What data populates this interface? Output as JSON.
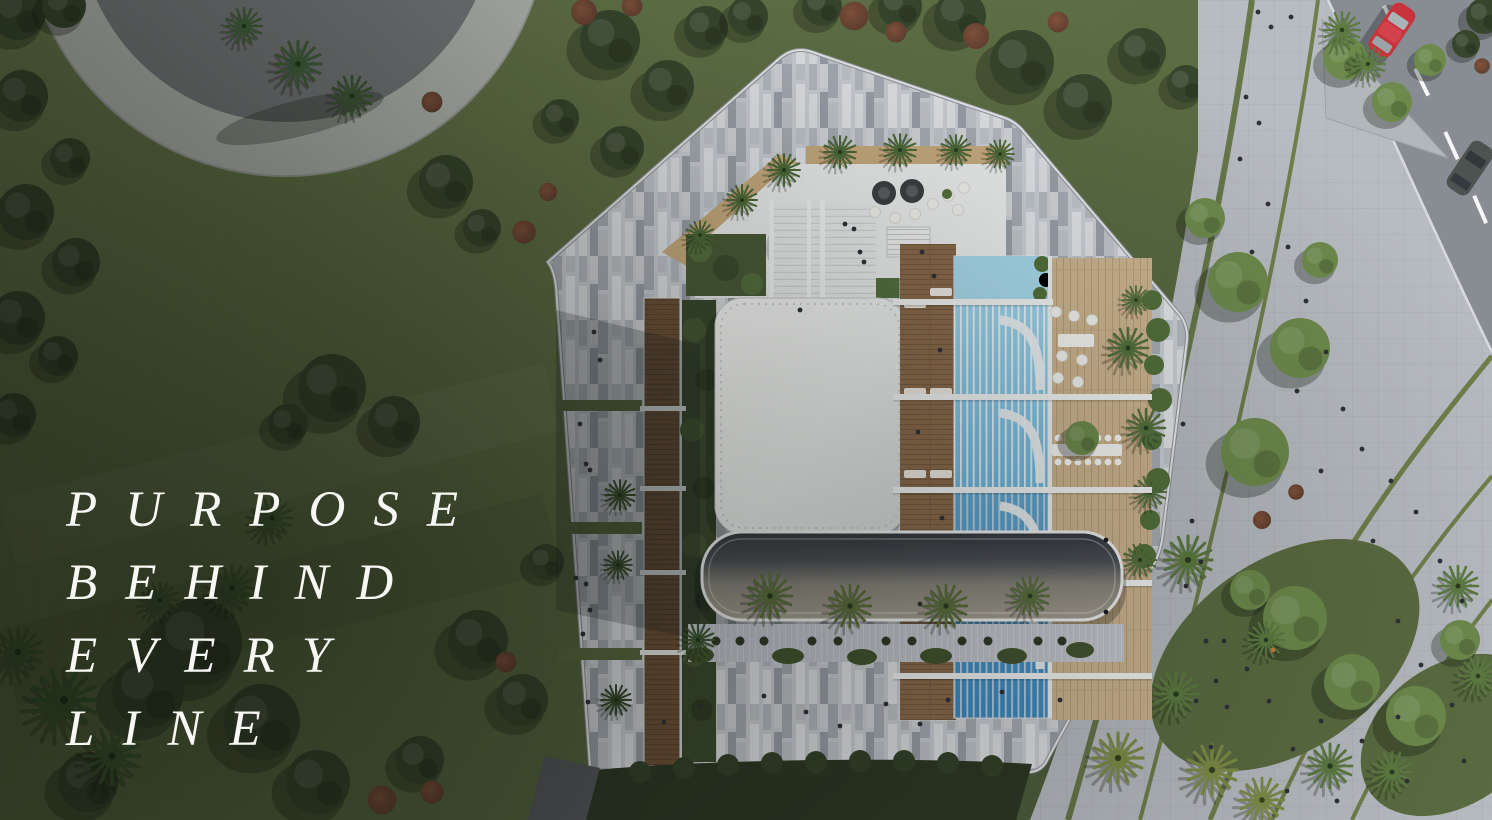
{
  "headline": {
    "lines": [
      "PURPOSE",
      "BEHIND",
      "EVERY",
      "LINE"
    ],
    "color": "#f7f7f4"
  },
  "scene": {
    "palette": {
      "lawn": "#5e7046",
      "lawn_shadow": "#3a482e",
      "tree_dark": "#36462c",
      "tree_bright": "#6d8a4c",
      "plaza_pavement": "#b7bcc2",
      "mosaic_light": "#ccd1d7",
      "road": "#878d93",
      "curb_white": "#e9ebec",
      "pool_blue": "#5fa9d8",
      "wood_deck": "#8b6b4d",
      "terrace_wood": "#cdb591",
      "roof_white": "#f2f3f2",
      "roof_dark": "#44494f",
      "plaza_disc": "#76777a",
      "car_red": "#c8333c",
      "car_dark": "#4c5350",
      "umbrella_yellow": "#e8b93a",
      "hedge": "#2c3824"
    }
  }
}
